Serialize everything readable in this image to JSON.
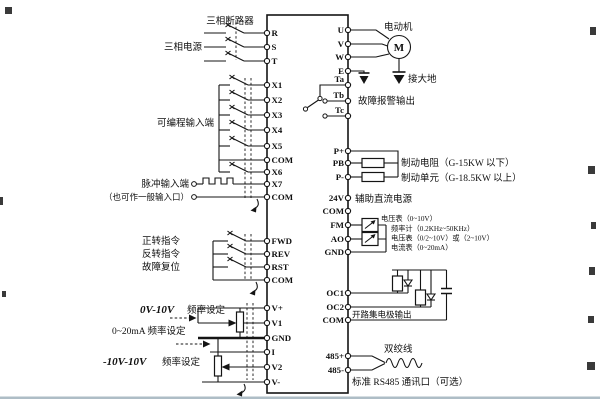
{
  "colors": {
    "background": "#ffffff",
    "line": "#141414",
    "page_rule": "#aebdc6"
  },
  "diagram": {
    "power_input": {
      "breaker_label": "三相断路器",
      "source_label": "三相电源",
      "terminals": [
        "R",
        "S",
        "T"
      ]
    },
    "programmable": {
      "label": "可编程输入端",
      "terminals": [
        "X1",
        "X2",
        "X3",
        "X4",
        "X5",
        "COM"
      ]
    },
    "pulse": {
      "label": "脉冲输入端",
      "note": "（也可作一般输入口）",
      "terminals": [
        "X6",
        "X7",
        "COM"
      ]
    },
    "commands": {
      "forward": "正转指令",
      "reverse": "反转指令",
      "reset": "故障复位",
      "terminals": [
        "FWD",
        "REV",
        "RST",
        "COM"
      ]
    },
    "analog_in": {
      "range1": "0V-10V",
      "range1_suffix": "频率设定",
      "range2": "0~20mA 频率设定",
      "range3": "-10V-10V",
      "range3_suffix": "频率设定",
      "terminals": [
        "V+",
        "V1",
        "GND",
        "I",
        "V2",
        "V-"
      ]
    },
    "motor": {
      "label": "电动机",
      "symbol": "M",
      "ground_label": "接大地",
      "terminals": [
        "U",
        "V",
        "W",
        "E"
      ]
    },
    "relay": {
      "label": "故障报警输出",
      "terminals": [
        "Ta",
        "Tb",
        "Tc"
      ]
    },
    "brake": {
      "resistor_label": "制动电阻（G-15KW 以下）",
      "unit_label": "制动单元（G-18.5KW 以上）",
      "terminals": [
        "P+",
        "PB",
        "P-"
      ]
    },
    "aux_power": {
      "label": "辅助直流电源",
      "terminals": [
        "24V",
        "COM"
      ]
    },
    "analog_out": {
      "meters": [
        "电压表（0~10V）",
        "频率计（0.2KHz~50KHz）",
        "电压表（0/2~10V）或（2~10V）",
        "电流表（0~20mA）"
      ],
      "terminals": [
        "FM",
        "AO",
        "GND"
      ]
    },
    "open_collector": {
      "label": "开路集电极输出",
      "terminals": [
        "OC1",
        "OC2",
        "COM"
      ]
    },
    "comm": {
      "twisted_pair_label": "双绞线",
      "label": "标准 RS485 通讯口（可选）",
      "terminals": [
        "485+",
        "485-"
      ]
    }
  }
}
